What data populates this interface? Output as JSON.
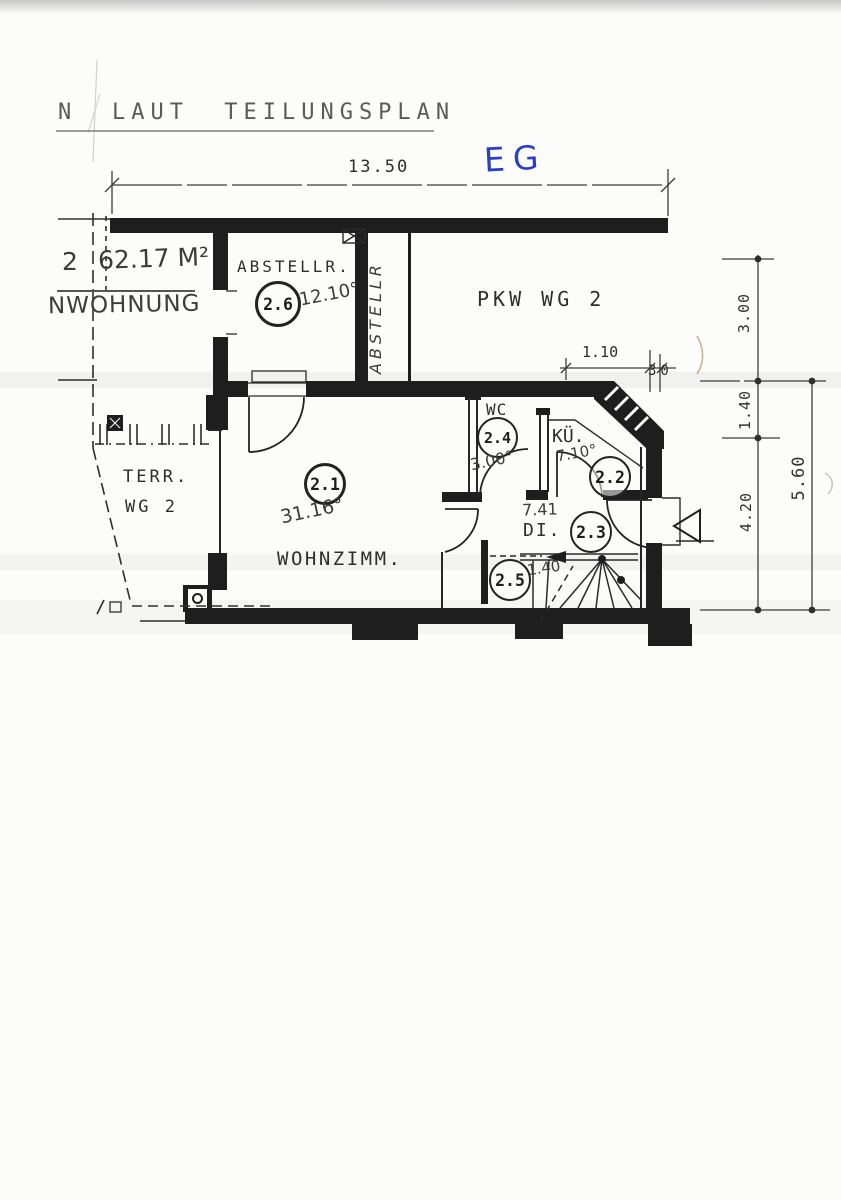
{
  "title": {
    "part1": "N",
    "part2": "LAUT TEILUNGSPLAN"
  },
  "floor_label": "EG",
  "plan": {
    "top_dimension": "13.50",
    "unit_number": "2",
    "unit_area": "62.17 M²",
    "unit_name": "NWOHNUNG",
    "parking_label": "PKW WG 2",
    "terrace_line1": "TERR.",
    "terrace_line2": "WG 2",
    "storage_vertical": "ABSTELLR",
    "dim_110": "1.10",
    "dim_30": "30",
    "right_dims": {
      "d1": "3.00",
      "d2": "1.40",
      "d3": "4.20",
      "outer": "5.60"
    },
    "rooms": {
      "storage": {
        "id": "2.6",
        "name": "ABSTELLR.",
        "area": "12.10°"
      },
      "living": {
        "id": "2.1",
        "name": "WOHNZIMM.",
        "area": "31.16°"
      },
      "wc": {
        "id": "2.4",
        "name": "WC",
        "area": "3.00°"
      },
      "kitchen": {
        "id": "2.2",
        "name": "KÜ.",
        "area": "7.10°"
      },
      "hall": {
        "id": "2.3",
        "name": "DI.",
        "area": "7.41"
      },
      "nook": {
        "id": "2.5",
        "area": "1.40"
      }
    }
  },
  "colors": {
    "ink": "#1e1e1e",
    "pencil": "#4f4f4f",
    "blue_pen": "#2b3fc4",
    "paper": "#fcfcfb"
  }
}
